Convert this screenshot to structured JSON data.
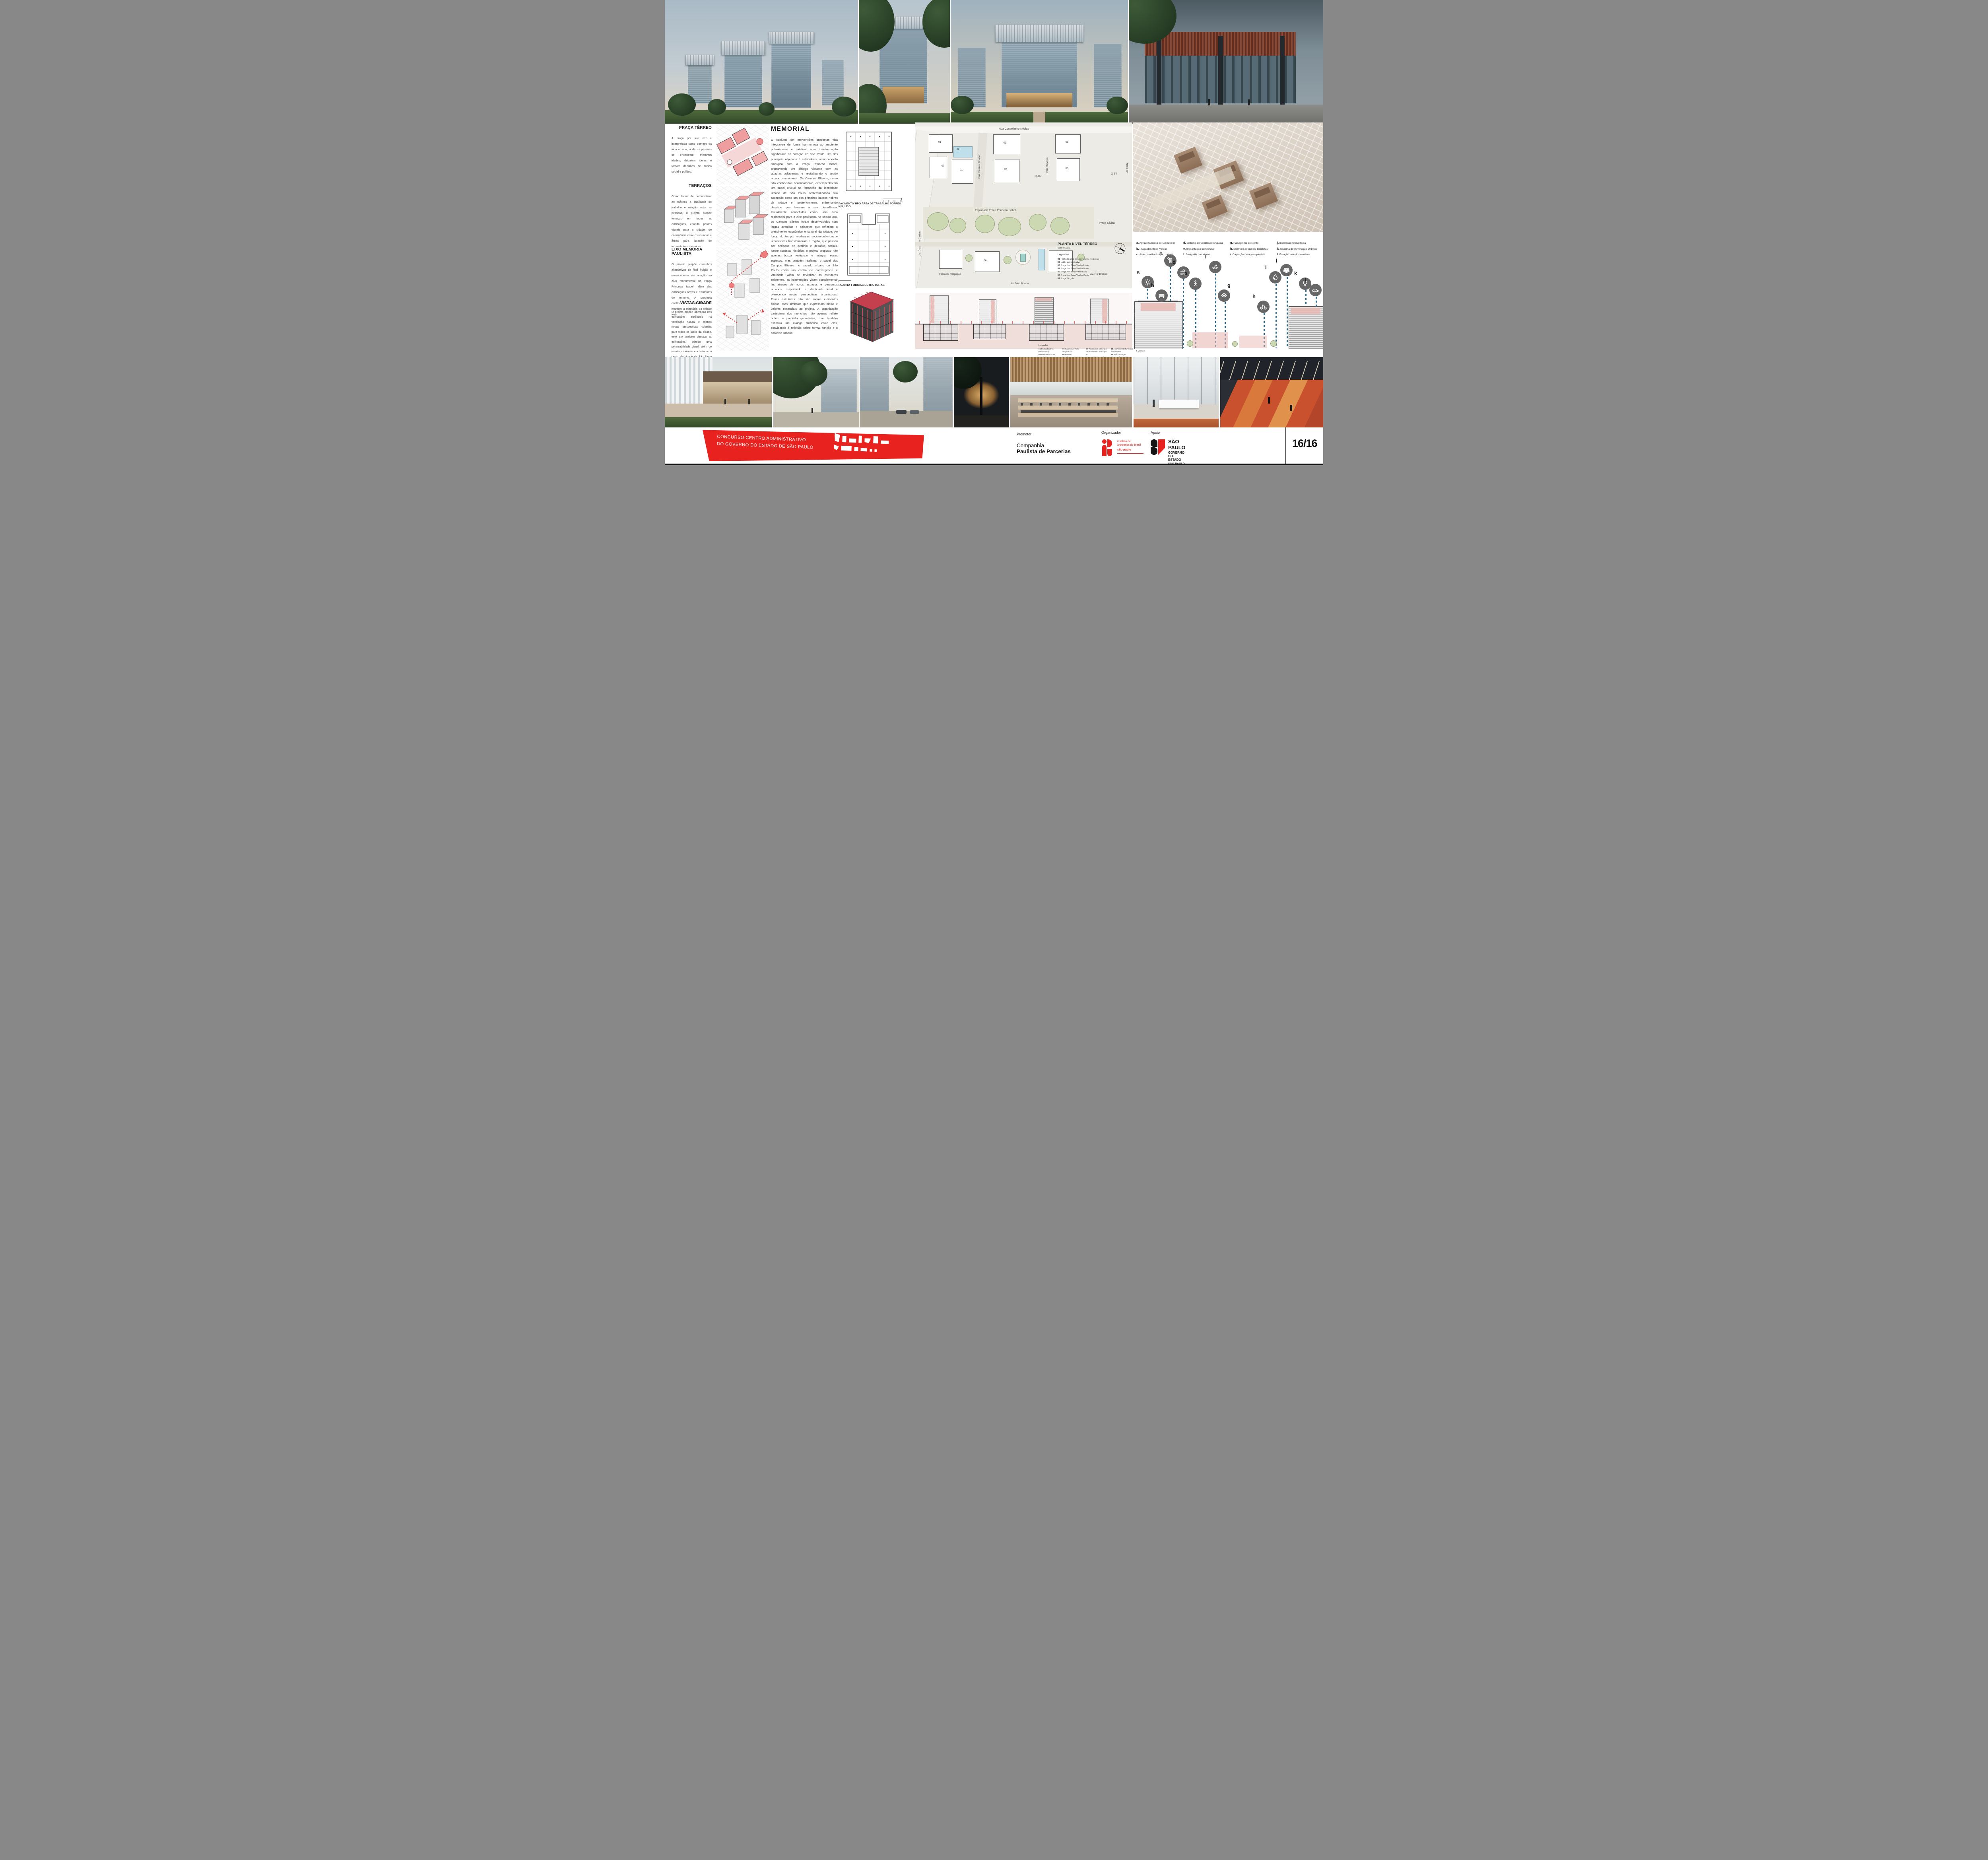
{
  "page_number": "16/16",
  "banner": {
    "line1": "CONCURSO CENTRO ADMINISTRATIVO",
    "line2": "DO GOVERNO DO ESTADO DE SÃO PAULO"
  },
  "footer": {
    "promotor_label": "Promotor",
    "promotor_line1": "Companhia",
    "promotor_line2": "Paulista de Parcerias",
    "organizador_label": "Organizador",
    "iab_line1": "instituto de",
    "iab_line2": "arquitetos do brasil",
    "iab_line3": "são paulo",
    "apoio_label": "Apoio",
    "sp_line1": "SÃO PAULO",
    "sp_line2": "GOVERNO DO ESTADO",
    "sp_line3": "SÃO PAULO SÃO TODOS"
  },
  "left_sections": [
    {
      "title": "PRAÇA TÉRREO",
      "text": "A praça por sua vez é interpretada como começo da vida urbana, onde as pessoas se encontram, misturam idades, debatem ideias e tomam decisões de cunho social e político."
    },
    {
      "title": "TERRAÇOS",
      "text": "Como forma de potencializar ao máximo a qualidade de trabalho e relação entre as pessoas, o projeto propõe terraços em todos as edificações, criando pontos visuais para a cidade, de convivência entre os usuários e áreas para locação de infraestruturas técnicas."
    },
    {
      "title": "EIXO MEMÓRIA PAULISTA",
      "text": "O projeto propõe caminhos alternativos de fácil fruição e entendimento em relação ao eixo monumental na Praça Princesa Isabel, além das edificações novas e existentes do entorno. A proposta enaltece os encontros e mantém a memória da cidade viva."
    },
    {
      "title": "VISTAS CIDADE",
      "text": "O projeto propõe aberturas nas edificações auxiliando na ventilação natural e criando novas perspectivas voltadas para todos os lados da cidade, este ato também destaca as edificações, criando uma permeabilidade visual, além de manter as visuais e a história do centro da cidade de São Paulo viva."
    }
  ],
  "memorial": {
    "title": "MEMORIAL",
    "text": "O conjunto de intervenções propostas visa integrar-se de forma harmoniosa ao ambiente pré-existente e catalisar uma transformação significativa no coração de São Paulo. Um dos principais objetivos é estabelecer uma conexão sinérgica com a Praça Princesa Isabel, promovendo um diálogo vibrante com as quadras adjacentes e revitalizando o tecido urbano circundante. Os Campos Elíseos, como são conhecidos historicamente, desempenharam um papel crucial na formação da identidade urbana de São Paulo, testemunhando sua ascensão como um dos primeiros bairros nobres da cidade e, posteriormente, enfrentando desafios que levaram à sua decadência. Inicialmente concebidos como uma área residencial para a elite paulistana no século XIX, os Campos Elíseos foram desenvolvidos com largas avenidas e palacetes que refletiam o crescimento econômico e cultural da cidade. Ao longo do tempo, mudanças socioeconômicas e urbanísticas transformaram a região, que passou por períodos de declínio e desafios sociais. Neste contexto histórico, o projeto proposto não apenas busca revitalizar e integrar esses espaços, mas também reafirmar o papel dos Campos Elíseos no traçado urbano de São Paulo como um centro de convergência e vitalidade. Além de revitalizar as estruturas existentes, as intervenções visam complementá-las através de novos espaços e percursos urbanos, respeitando a identidade local e oferecendo novas perspectivas urbanísticas. Essas estruturas não são meros elementos físicos, mas símbolos que expressam ideias e valores essenciais ao projeto.  A organização cartesiana dos monolitos não apenas reflete ordem e precisão geométrica, mas também estimula um diálogo dinâmico entre eles, convidando à reflexão sobre forma, função e o contexto urbano."
  },
  "plans": {
    "plan1_caption": "PAVIMENTO TIPO ÁREA DE TRABALHO TORRES N,S,L E O",
    "plan2_caption": "PLANTA FORMAS ESTRUTURAS",
    "scale_ticks": [
      "0",
      "5",
      "10",
      "20"
    ]
  },
  "site_plan": {
    "title": "PLANTA NÍVEL TÉRREO",
    "subtitle": "sem escala",
    "legend_title": "Legendas",
    "legend": [
      {
        "num": "01",
        "label": "Fachada ativa",
        "suffix": "80% de mezanino + sobreloja"
      },
      {
        "num": "02",
        "label": "Lobby administrativo",
        "suffix": ""
      },
      {
        "num": "03",
        "label": "Praça das Boas Vindas Leste",
        "suffix": ""
      },
      {
        "num": "04",
        "label": "Praça das Boas Vindas Norte",
        "suffix": ""
      },
      {
        "num": "05",
        "label": "Praça das Boas Vindas Sul",
        "suffix": ""
      },
      {
        "num": "06",
        "label": "Praça das Boas Vindas Oeste",
        "suffix": ""
      },
      {
        "num": "07",
        "label": "Praça Singular",
        "suffix": ""
      }
    ],
    "streets": [
      "Rua Conselheiro Nébias",
      "Av. Duque de Caxias",
      "Rua General Rondon",
      "Rua Helvétia",
      "Al. Glete",
      "Esplanada Praça Princesa Isabel",
      "Praça Cívica",
      "Faixa de mitigação",
      "Av.  Rio Branco",
      "Av. Dino Bueno"
    ],
    "quads": [
      "Q 52",
      "Q 46",
      "Q 34"
    ],
    "block_labels": [
      "01",
      "02",
      "07",
      "01",
      "03",
      "04",
      "01",
      "05",
      "06"
    ]
  },
  "sections_legend": {
    "title": "Legendas",
    "items": [
      {
        "num": "01",
        "label": "Fachada ativa"
      },
      {
        "num": "02",
        "label": "Sobreloja"
      },
      {
        "num": "03",
        "label": "Pavimento Adm. Singular 01"
      },
      {
        "num": "04",
        "label": "Varanda"
      },
      {
        "num": "05",
        "label": "Pavimento Adm. Singular 02"
      },
      {
        "num": "06",
        "label": "Rooftop"
      },
      {
        "num": "07",
        "label": "Subsolo - Garagem"
      },
      {
        "num": "08",
        "label": "Praça das Boas Vindas Sul"
      },
      {
        "num": "09",
        "label": "Pavimento adm. tipo"
      },
      {
        "num": "10",
        "label": "Pavimento adm. tipo 02"
      },
      {
        "num": "11",
        "label": "Varanda Praça nível monumento"
      },
      {
        "num": "12",
        "label": "Trabalho de autoridades"
      },
      {
        "num": "13",
        "label": "Apartamento funcional autoridades"
      },
      {
        "num": "14",
        "label": "Heliponto Q34"
      },
      {
        "num": "15",
        "label": "Varanda Mirante"
      },
      {
        "num": "16",
        "label": "Praça das águas"
      }
    ],
    "acessos_title": "Acessos",
    "acessos": [
      {
        "key": "A",
        "label": "Pedestres"
      },
      {
        "key": "B",
        "label": "Veículos"
      }
    ]
  },
  "sustainability": {
    "items": [
      {
        "key": "a.",
        "label": "Aproveitamento de luz natural"
      },
      {
        "key": "b.",
        "label": "Praça das Boas Vindas"
      },
      {
        "key": "c.",
        "label": "Átrio com iluminação natural"
      },
      {
        "key": "d.",
        "label": "Sistema de ventilação cruzada"
      },
      {
        "key": "e.",
        "label": "Implantação caminhável"
      },
      {
        "key": "f.",
        "label": "Serigrafia nos vidros"
      },
      {
        "key": "g.",
        "label": "Paisagismo existente"
      },
      {
        "key": "h.",
        "label": "Estímulo ao uso de bicicletas"
      },
      {
        "key": "i.",
        "label": "Captação de águas pluviais"
      },
      {
        "key": "j.",
        "label": "Instalação fotovoltaica"
      },
      {
        "key": "k.",
        "label": "Sistema de iluminação 901m/w"
      },
      {
        "key": "l.",
        "label": "Estação veículos elétricos"
      }
    ]
  }
}
